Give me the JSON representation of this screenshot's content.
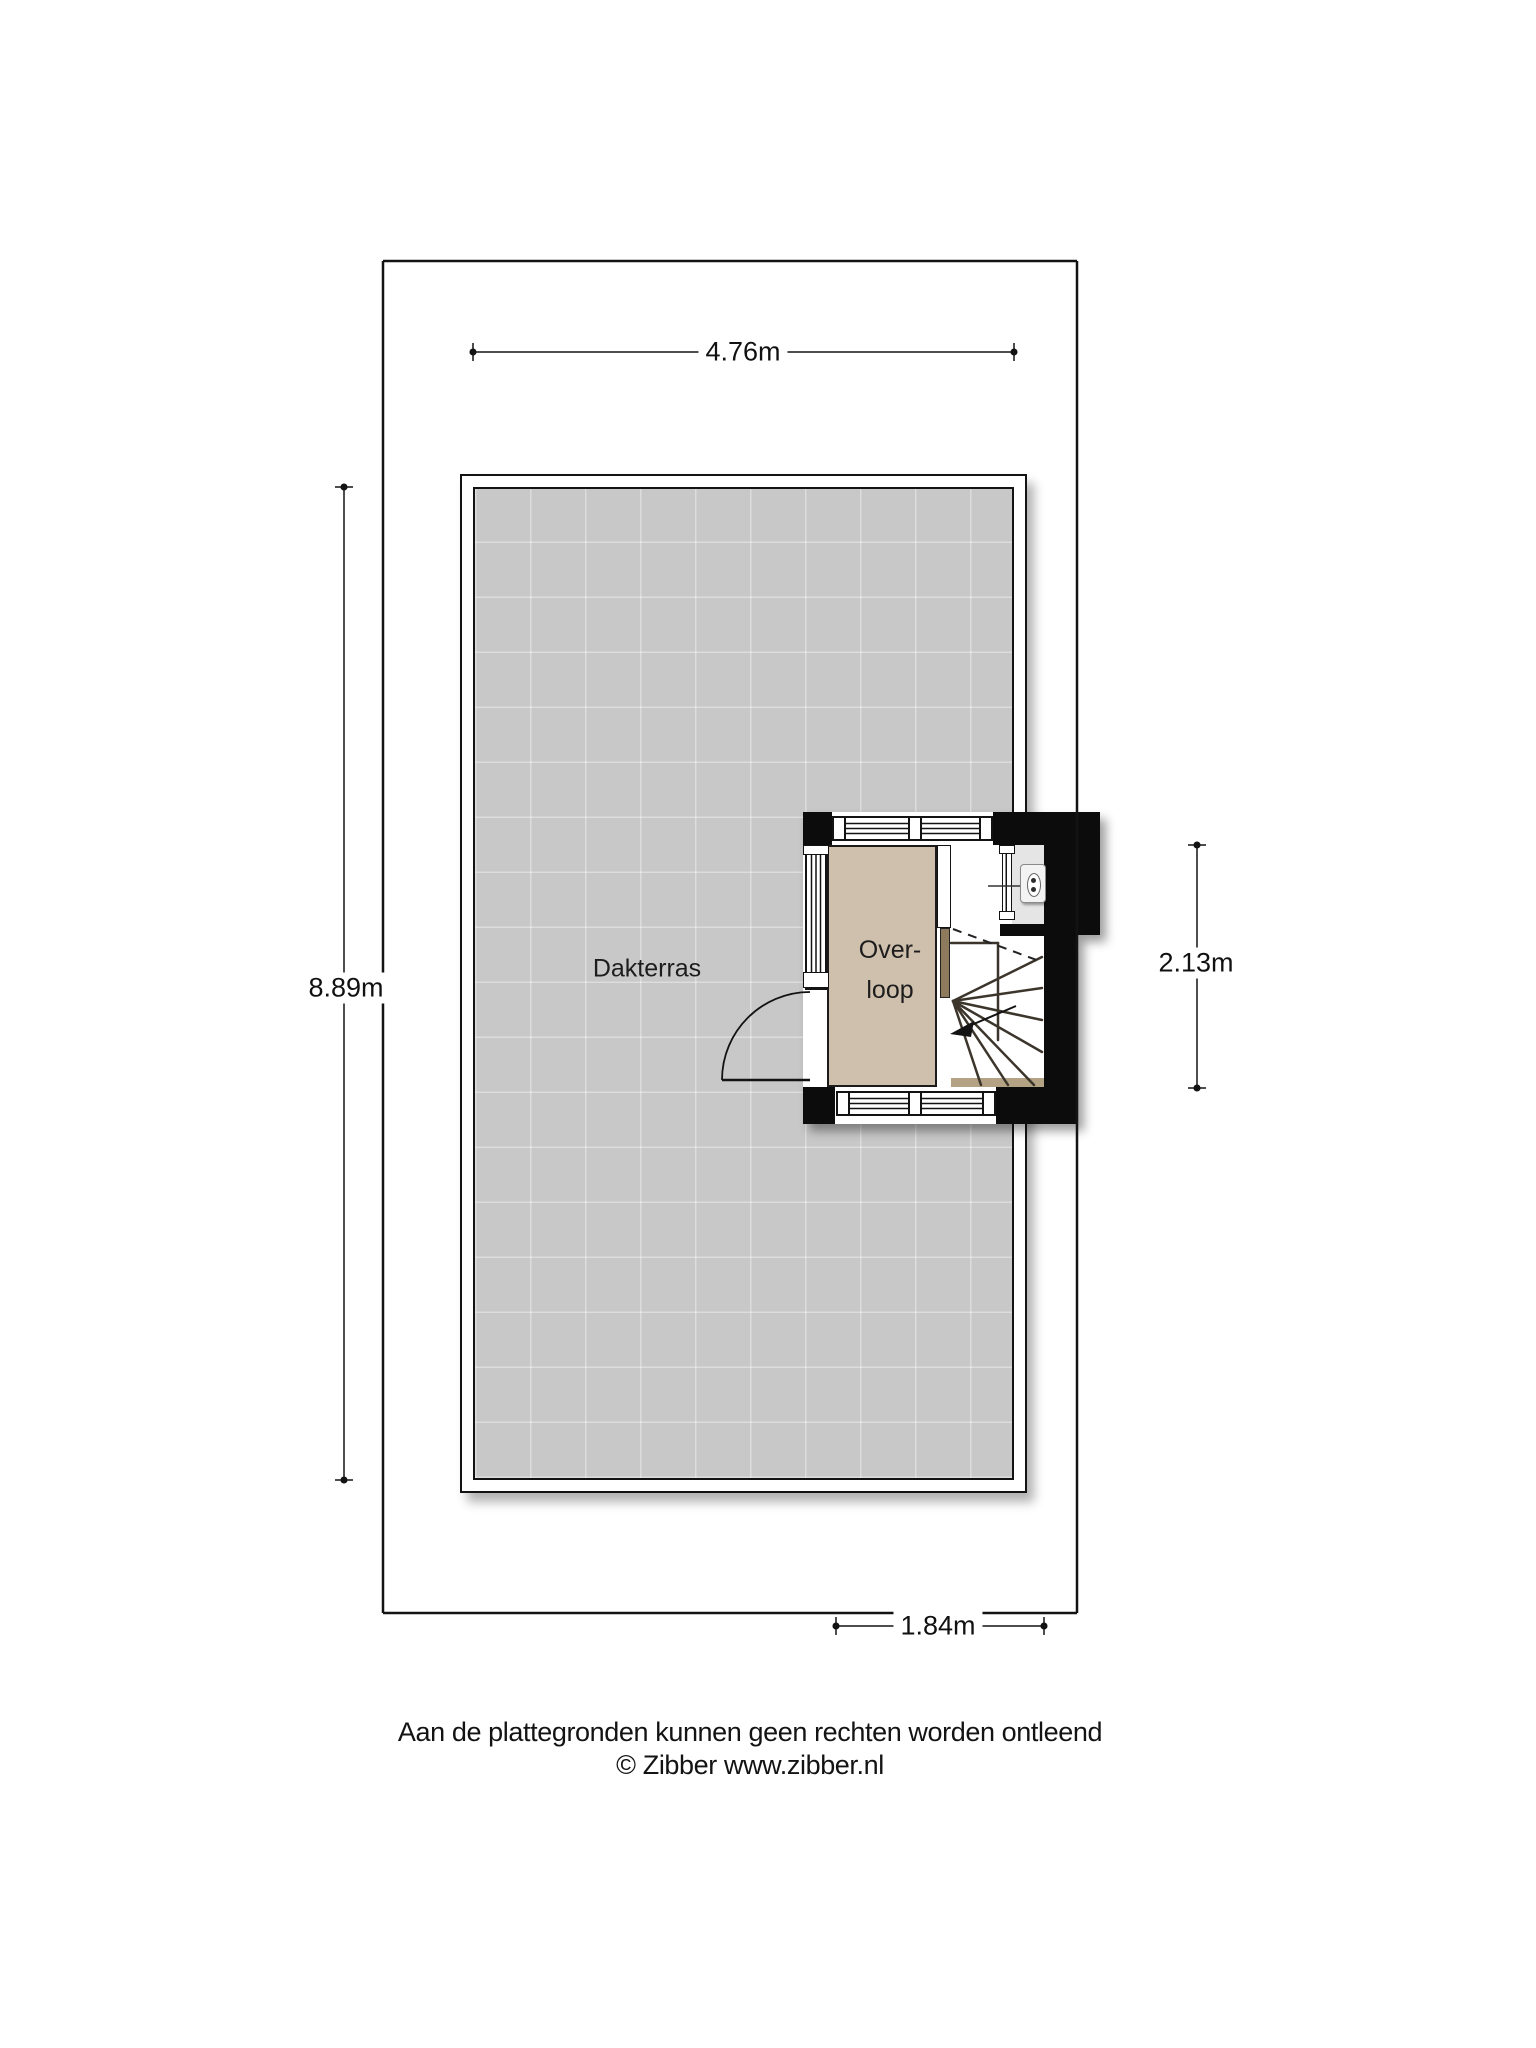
{
  "floorplan": {
    "rooms": {
      "dakterras": {
        "label": "Dakterras"
      },
      "overloop": {
        "label": "Overloop",
        "line1": "Over-",
        "line2": "loop"
      }
    },
    "dimensions": {
      "terrace_width": "4.76m",
      "terrace_height": "8.89m",
      "stairwell_height": "2.13m",
      "stairwell_width": "1.84m"
    },
    "footer": {
      "disclaimer": "Aan de plattegronden kunnen geen rechten worden ontleend",
      "copyright": "© Zibber www.zibber.nl"
    },
    "icons": {
      "wall_unit": "wall-unit-icon",
      "stairs": "winder-stairs",
      "door": "door-swing-arc",
      "direction_arrow": "stair-direction-arrow"
    },
    "colors": {
      "terrace_floor": "#c8c8c8",
      "overloop_floor": "#cec0ad",
      "tech_floor": "#e5e5e5",
      "wall_black": "#0c0c0c",
      "door_panel_brown": "#8e7a5c",
      "line": "#131313"
    }
  }
}
